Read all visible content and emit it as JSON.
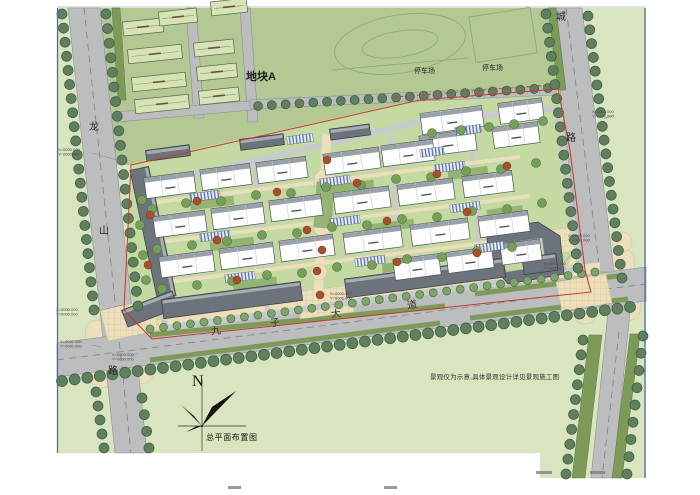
{
  "map": {
    "plot_a_label": "地块A",
    "parking_label_1": "停车场",
    "parking_label_2": "停车场",
    "west_road_char_1": "龙",
    "west_road_char_2": "山",
    "west_road_char_3": "路",
    "east_road_char_1": "城",
    "east_road_char_2": "路",
    "avenue_char_1": "九",
    "avenue_char_2": "子",
    "avenue_char_3": "大",
    "avenue_char_4": "道",
    "north_letter": "N",
    "drawing_title": "总平面布置图",
    "landscape_note": "景观仅为示意,具体景观设计详见景观施工图",
    "coord_x": "X=0000.000",
    "coord_y": "Y=0000.000"
  },
  "colors": {
    "base-green": "#d9e5bf",
    "sage-green": "#b3c893",
    "road-gray": "#bcbdbf",
    "road-edge": "#8f9092",
    "tree-dark": "#5f7f5e",
    "tree-light": "#7ca46b",
    "median-olive": "#7d9a58",
    "plaza-tan": "#ecdfbc",
    "building-white": "#fdfdfd",
    "commercial-gray": "#6d737a",
    "plota-green": "#d5e3b5",
    "courtyard-green": "#c5d9a2",
    "garden-green": "#92b170",
    "red-line": "#c8392b",
    "red-tree": "#a8502c",
    "border-blue": "#4a66a8",
    "parking-blue": "#5872a8",
    "text-dark": "#1a1a1a"
  }
}
